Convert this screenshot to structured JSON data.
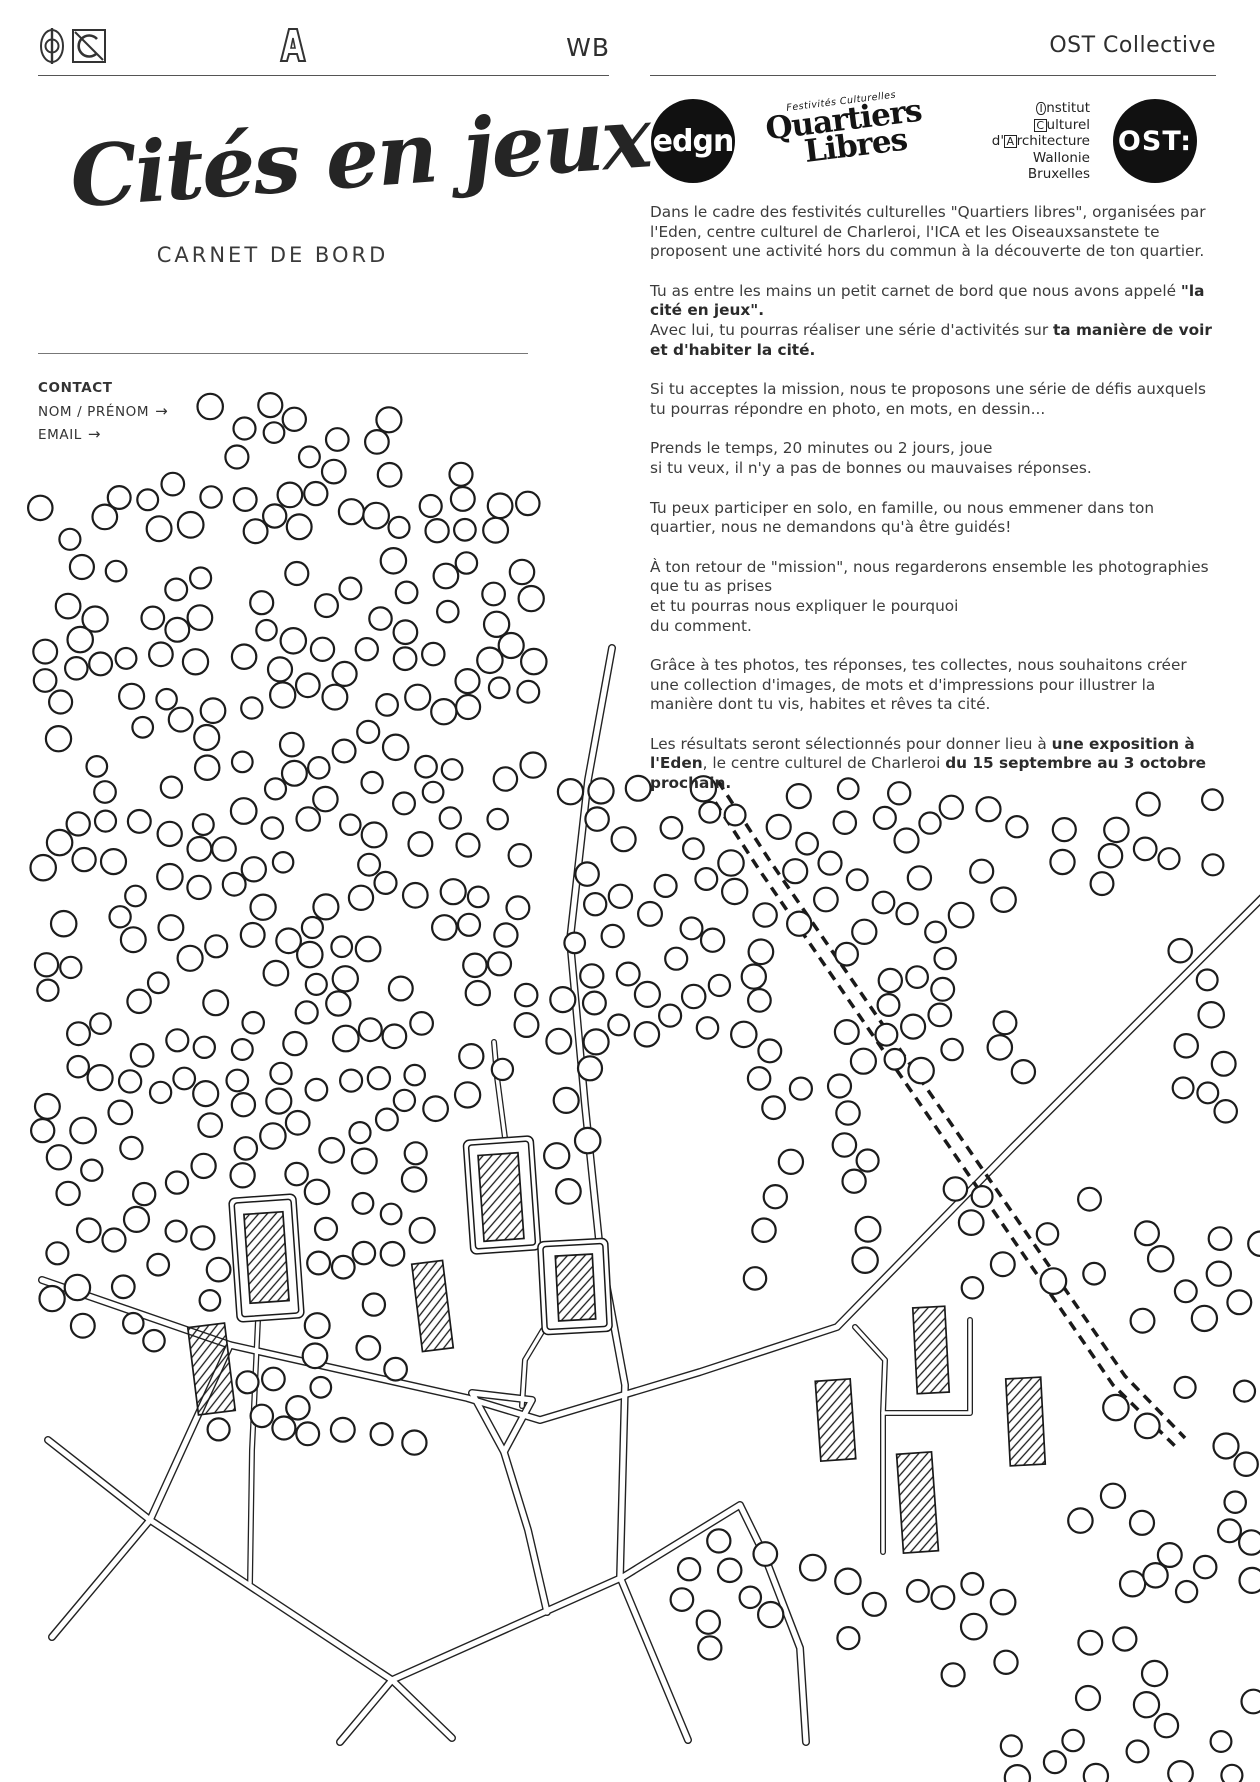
{
  "header": {
    "wb": "WB",
    "ost_collective": "OST Collective"
  },
  "title": {
    "script": "Cités en jeux",
    "subtitle": "CARNET DE BORD"
  },
  "contact": {
    "label": "CONTACT",
    "fields": [
      {
        "label": "NOM / PRÉNOM",
        "arrow": "→"
      },
      {
        "label": "EMAIL",
        "arrow": "→"
      }
    ]
  },
  "logos": {
    "edgn": "edgn",
    "quartiers_top": "Festivités Culturelles",
    "quartiers_1": "Quartiers",
    "quartiers_2": "Libres",
    "ost": "OST:",
    "ica_lines": [
      {
        "pre": "",
        "glyph": "I",
        "shape": "oval",
        "rest": "nstitut"
      },
      {
        "pre": "",
        "glyph": "C",
        "shape": "box",
        "rest": "ulturel"
      },
      {
        "pre": "d'",
        "glyph": "A",
        "shape": "box",
        "rest": "rchitecture"
      },
      {
        "pre": "",
        "glyph": "",
        "shape": "",
        "rest": "Wallonie"
      },
      {
        "pre": "",
        "glyph": "",
        "shape": "",
        "rest": "Bruxelles"
      }
    ]
  },
  "paragraphs": [
    [
      {
        "t": "Dans le cadre des festivités culturelles \"Quartiers libres\", organisées par l'Eden, centre culturel de Charleroi, l'ICA et les Oiseauxsanstete te proposent une activité hors du commun à la découverte de ton quartier.",
        "b": false
      }
    ],
    [
      {
        "t": "Tu as entre les mains un petit carnet de bord  que nous avons appelé ",
        "b": false
      },
      {
        "t": "\"la cité en jeux\".",
        "b": true
      },
      {
        "t": "\nAvec lui, tu pourras réaliser une série d'activités sur ",
        "b": false
      },
      {
        "t": "ta manière de voir et d'habiter la cité.",
        "b": true
      }
    ],
    [
      {
        "t": "Si tu acceptes la mission, nous te proposons  une série de défis auxquels tu pourras répondre en photo, en mots, en dessin...",
        "b": false
      }
    ],
    [
      {
        "t": "Prends le temps, 20 minutes ou 2 jours,  joue\nsi tu veux, il n'y a pas de bonnes ou mauvaises réponses.",
        "b": false
      }
    ],
    [
      {
        "t": "Tu peux participer en solo, en famille, ou nous emmener dans ton quartier, nous ne demandons qu'à être guidés!",
        "b": false
      }
    ],
    [
      {
        "t": "À ton retour de \"mission\", nous regarderons  ensemble les photographies que tu as prises\net tu pourras nous expliquer le pourquoi\ndu comment.",
        "b": false
      }
    ],
    [
      {
        "t": "Grâce à tes photos, tes réponses, tes collectes, nous souhaitons créer une collection d'images, de mots et d'impressions pour illustrer la manière dont tu vis, habites et rêves ta cité.",
        "b": false
      }
    ],
    [
      {
        "t": "Les résultats seront sélectionnés pour donner lieu à ",
        "b": false
      },
      {
        "t": "une exposition à l'Eden",
        "b": true
      },
      {
        "t": ", le centre culturel de Charleroi ",
        "b": false
      },
      {
        "t": "du 15 septembre au 3 octobre prochain.",
        "b": true
      }
    ]
  ],
  "map": {
    "ink": "#1a1a1a",
    "road_casing": "#222222",
    "tree_stroke": "#1c1c1c",
    "seed": 7,
    "tree_min_dist": 24,
    "roads": [
      [
        [
          42,
          1280
        ],
        [
          230,
          1345
        ],
        [
          467,
          1398
        ],
        [
          540,
          1420
        ],
        [
          700,
          1372
        ],
        [
          837,
          1327
        ],
        [
          1012,
          1148
        ],
        [
          1150,
          1010
        ],
        [
          1262,
          898
        ]
      ],
      [
        [
          612,
          648
        ],
        [
          588,
          780
        ],
        [
          570,
          940
        ],
        [
          585,
          1105
        ],
        [
          600,
          1250
        ],
        [
          625,
          1385
        ],
        [
          620,
          1577
        ],
        [
          688,
          1740
        ]
      ],
      [
        [
          48,
          1440
        ],
        [
          150,
          1520
        ],
        [
          392,
          1680
        ],
        [
          623,
          1577
        ]
      ],
      [
        [
          230,
          1345
        ],
        [
          150,
          1520
        ],
        [
          52,
          1637
        ]
      ],
      [
        [
          392,
          1680
        ],
        [
          340,
          1742
        ]
      ],
      [
        [
          392,
          1680
        ],
        [
          452,
          1738
        ]
      ],
      [
        [
          504,
          1452
        ],
        [
          528,
          1530
        ],
        [
          547,
          1612
        ]
      ],
      [
        [
          623,
          1577
        ],
        [
          740,
          1505
        ],
        [
          763,
          1552
        ],
        [
          800,
          1648
        ],
        [
          806,
          1742
        ]
      ],
      [
        [
          472,
          1393
        ],
        [
          532,
          1400
        ],
        [
          504,
          1452
        ],
        [
          472,
          1393
        ]
      ]
    ],
    "stems": [
      [
        [
          258,
          1320
        ],
        [
          252,
          1450
        ],
        [
          250,
          1583
        ]
      ],
      [
        [
          505,
          1138
        ],
        [
          497,
          1077
        ],
        [
          494,
          1042
        ]
      ],
      [
        [
          543,
          1330
        ],
        [
          525,
          1360
        ],
        [
          522,
          1406
        ]
      ],
      [
        [
          970,
          1320
        ],
        [
          970,
          1413
        ],
        [
          883,
          1413
        ],
        [
          883,
          1552
        ]
      ],
      [
        [
          855,
          1327
        ],
        [
          885,
          1360
        ],
        [
          883,
          1413
        ]
      ]
    ],
    "railway": [
      [
        [
          706,
          788
        ],
        [
          758,
          868
        ],
        [
          1113,
          1385
        ],
        [
          1177,
          1448
        ]
      ],
      [
        [
          718,
          781
        ],
        [
          770,
          861
        ],
        [
          1125,
          1376
        ],
        [
          1185,
          1438
        ]
      ]
    ],
    "plots": [
      {
        "x": 233,
        "y": 1196,
        "w": 67,
        "h": 124,
        "rot": -4
      },
      {
        "x": 467,
        "y": 1138,
        "w": 70,
        "h": 114,
        "rot": -4
      },
      {
        "x": 540,
        "y": 1240,
        "w": 70,
        "h": 93,
        "rot": -3
      }
    ],
    "buildings": [
      {
        "x": 247,
        "y": 1213,
        "w": 39,
        "h": 89,
        "rot": -4
      },
      {
        "x": 481,
        "y": 1154,
        "w": 40,
        "h": 86,
        "rot": -4
      },
      {
        "x": 557,
        "y": 1255,
        "w": 37,
        "h": 65,
        "rot": -3
      },
      {
        "x": 417,
        "y": 1262,
        "w": 31,
        "h": 88,
        "rot": -7
      },
      {
        "x": 193,
        "y": 1325,
        "w": 37,
        "h": 88,
        "rot": -7
      },
      {
        "x": 818,
        "y": 1380,
        "w": 35,
        "h": 80,
        "rot": -4
      },
      {
        "x": 915,
        "y": 1307,
        "w": 32,
        "h": 86,
        "rot": -3
      },
      {
        "x": 1008,
        "y": 1378,
        "w": 35,
        "h": 87,
        "rot": -3
      },
      {
        "x": 900,
        "y": 1453,
        "w": 35,
        "h": 99,
        "rot": -4
      }
    ],
    "tree_clusters": [
      {
        "x": 208,
        "y": 402,
        "w": 185,
        "h": 72,
        "n": 11
      },
      {
        "x": 150,
        "y": 474,
        "w": 380,
        "h": 58,
        "n": 22
      },
      {
        "x": 40,
        "y": 492,
        "w": 110,
        "h": 95,
        "n": 7
      },
      {
        "x": 42,
        "y": 560,
        "w": 492,
        "h": 190,
        "n": 64
      },
      {
        "x": 42,
        "y": 750,
        "w": 492,
        "h": 200,
        "n": 66
      },
      {
        "x": 40,
        "y": 950,
        "w": 495,
        "h": 165,
        "n": 52
      },
      {
        "x": 40,
        "y": 1115,
        "w": 385,
        "h": 215,
        "n": 46
      },
      {
        "x": 150,
        "y": 1330,
        "w": 265,
        "h": 115,
        "n": 13
      },
      {
        "x": 262,
        "y": 1382,
        "w": 78,
        "h": 52,
        "n": 4
      },
      {
        "x": 565,
        "y": 788,
        "w": 445,
        "h": 88,
        "n": 26
      },
      {
        "x": 680,
        "y": 876,
        "w": 330,
        "h": 60,
        "n": 13
      },
      {
        "x": 1010,
        "y": 795,
        "w": 205,
        "h": 95,
        "n": 11
      },
      {
        "x": 588,
        "y": 880,
        "w": 200,
        "h": 180,
        "n": 24
      },
      {
        "x": 552,
        "y": 940,
        "w": 40,
        "h": 350,
        "n": 8
      },
      {
        "x": 752,
        "y": 1078,
        "w": 52,
        "h": 215,
        "n": 7
      },
      {
        "x": 838,
        "y": 925,
        "w": 128,
        "h": 150,
        "n": 14
      },
      {
        "x": 838,
        "y": 1085,
        "w": 48,
        "h": 215,
        "n": 7
      },
      {
        "x": 993,
        "y": 1022,
        "w": 60,
        "h": 65,
        "n": 3
      },
      {
        "x": 1180,
        "y": 948,
        "w": 78,
        "h": 185,
        "n": 8
      },
      {
        "x": 955,
        "y": 1185,
        "w": 168,
        "h": 118,
        "n": 9
      },
      {
        "x": 1140,
        "y": 1225,
        "w": 122,
        "h": 118,
        "n": 9
      },
      {
        "x": 1075,
        "y": 1385,
        "w": 187,
        "h": 178,
        "n": 13
      },
      {
        "x": 680,
        "y": 1540,
        "w": 292,
        "h": 122,
        "n": 15
      },
      {
        "x": 950,
        "y": 1560,
        "w": 312,
        "h": 222,
        "n": 26
      }
    ],
    "tree_avoid": [
      [
        228,
        1186,
        80,
        140
      ],
      [
        460,
        1128,
        84,
        130
      ],
      [
        535,
        1232,
        82,
        108
      ],
      [
        408,
        1252,
        48,
        106
      ],
      [
        186,
        1316,
        52,
        104
      ],
      [
        810,
        1372,
        52,
        96
      ],
      [
        906,
        1299,
        50,
        102
      ],
      [
        998,
        1370,
        55,
        103
      ],
      [
        892,
        1445,
        52,
        115
      ]
    ]
  }
}
